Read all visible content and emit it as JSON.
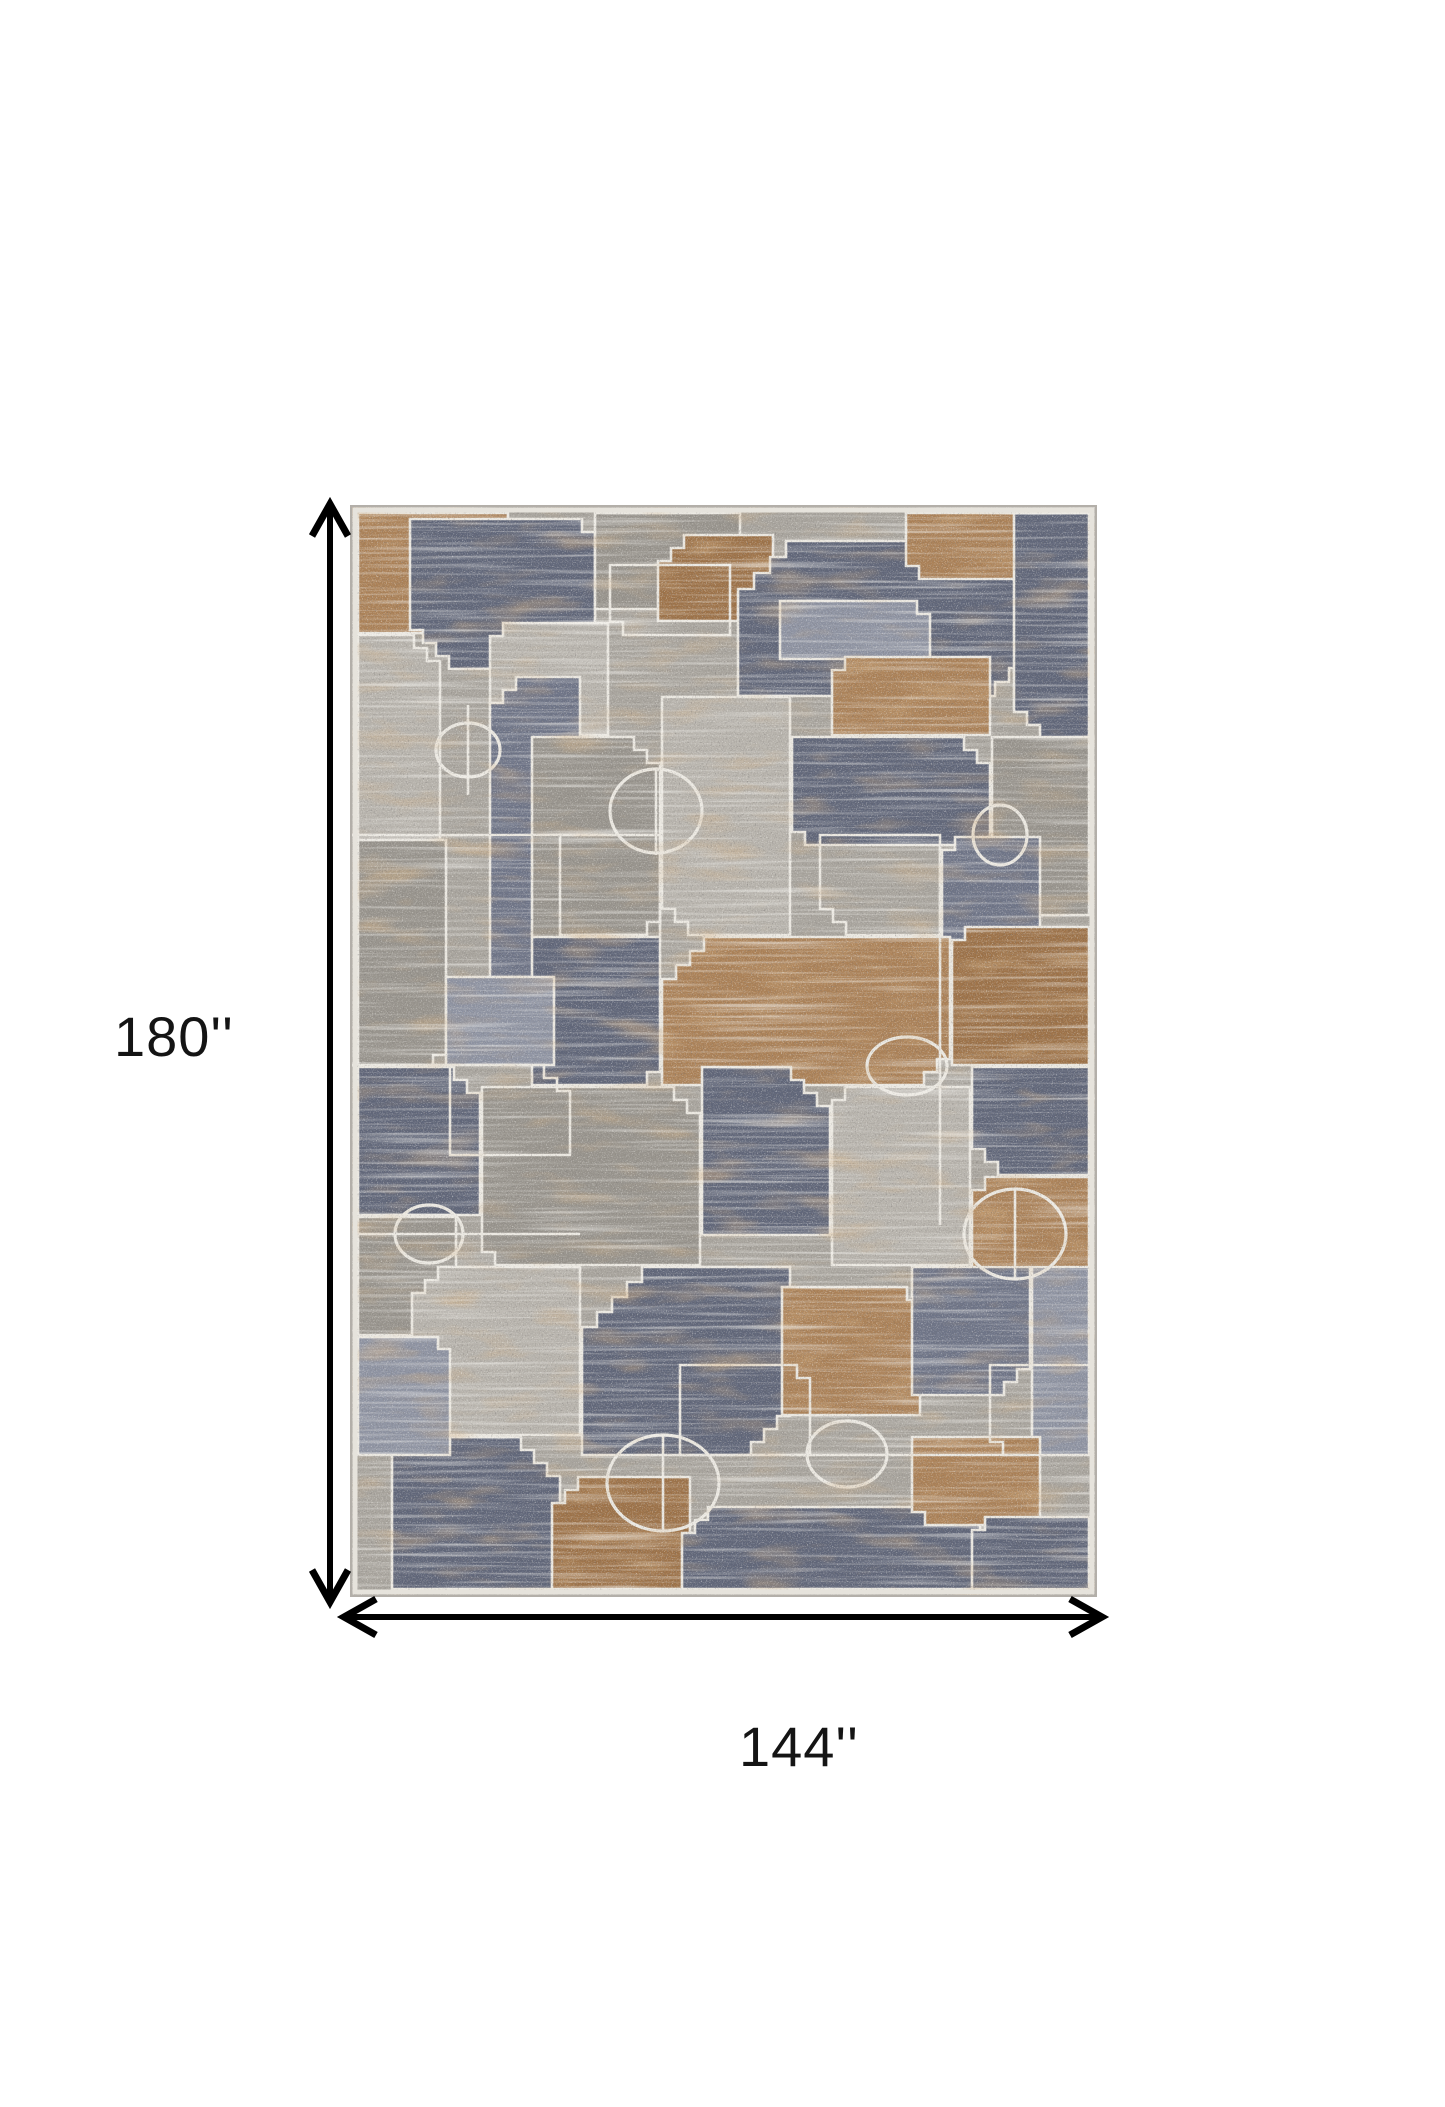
{
  "figure": {
    "type": "product-dimension-diagram",
    "subject": "geometric patchwork area rug"
  },
  "labels": {
    "height": {
      "text": "180''"
    },
    "width": {
      "text": "144''"
    }
  },
  "arrows": {
    "color": "#000000",
    "shaft_width": 6,
    "head_stroke_width": 7,
    "head_length": 32,
    "head_half_width": 18,
    "vertical": {
      "x": 330,
      "y_tip_top": 504,
      "y_tip_bottom": 1602
    },
    "horizontal": {
      "y": 1617,
      "x_tip_left": 344,
      "x_tip_right": 1102
    }
  },
  "rug": {
    "width": 747,
    "height": 1092,
    "palette": {
      "base": "#a8a49d",
      "slate": "#606679",
      "slate2": "#6e7487",
      "bgray": "#8e93a2",
      "gray": "#98948d",
      "lgray": "#b7b3ac",
      "tan": "#ab8157",
      "tan2": "#9d7248",
      "outline": "#ebe8e1",
      "edge_outer": "#b3afa9",
      "edge_inner": "#e6e3dc"
    },
    "patches": [
      {
        "x": 8,
        "y": 8,
        "w": 150,
        "h": 120,
        "f": "tan",
        "st": {
          "br": [
            3,
            13
          ]
        }
      },
      {
        "x": 60,
        "y": 14,
        "w": 185,
        "h": 150,
        "f": "slate",
        "st": {
          "bl": [
            4,
            13
          ],
          "tr": [
            2,
            13
          ]
        }
      },
      {
        "x": 245,
        "y": 8,
        "w": 145,
        "h": 96,
        "f": "gray",
        "st": {
          "br": [
            2,
            13
          ]
        }
      },
      {
        "x": 308,
        "y": 30,
        "w": 115,
        "h": 86,
        "f": "tan2",
        "st": {
          "tl": [
            3,
            13
          ]
        }
      },
      {
        "x": 388,
        "y": 36,
        "w": 285,
        "h": 155,
        "f": "slate",
        "st": {
          "tl": [
            4,
            16
          ],
          "br": [
            3,
            14
          ]
        }
      },
      {
        "x": 556,
        "y": 8,
        "w": 112,
        "h": 66,
        "f": "tan",
        "st": {
          "bl": [
            2,
            13
          ]
        }
      },
      {
        "x": 664,
        "y": 8,
        "w": 75,
        "h": 225,
        "f": "slate",
        "st": {
          "bl": [
            3,
            13
          ]
        }
      },
      {
        "x": 430,
        "y": 96,
        "w": 150,
        "h": 58,
        "f": "bgray",
        "st": {
          "tr": [
            2,
            13
          ]
        }
      },
      {
        "x": 140,
        "y": 118,
        "w": 118,
        "h": 112,
        "f": "lgray",
        "st": {
          "tl": [
            2,
            13
          ]
        }
      },
      {
        "x": 8,
        "y": 130,
        "w": 82,
        "h": 205,
        "f": "lgray",
        "st": {
          "tr": [
            3,
            13
          ]
        }
      },
      {
        "x": 140,
        "y": 172,
        "w": 90,
        "h": 300,
        "f": "slate2",
        "st": {
          "tl": [
            3,
            13
          ],
          "br": [
            3,
            13
          ]
        }
      },
      {
        "x": 8,
        "y": 335,
        "w": 88,
        "h": 228,
        "f": "gray",
        "st": {
          "br": [
            2,
            13
          ]
        }
      },
      {
        "x": 182,
        "y": 232,
        "w": 128,
        "h": 200,
        "f": "gray",
        "st": {
          "tr": [
            3,
            13
          ]
        }
      },
      {
        "x": 312,
        "y": 192,
        "w": 128,
        "h": 238,
        "f": "lgray",
        "st": {
          "bl": [
            3,
            13
          ]
        }
      },
      {
        "x": 442,
        "y": 232,
        "w": 198,
        "h": 108,
        "f": "slate",
        "st": {
          "tr": [
            3,
            13
          ],
          "bl": [
            2,
            13
          ]
        }
      },
      {
        "x": 482,
        "y": 152,
        "w": 158,
        "h": 78,
        "f": "tan",
        "st": {
          "tl": [
            2,
            13
          ]
        }
      },
      {
        "x": 642,
        "y": 232,
        "w": 97,
        "h": 178,
        "f": "gray",
        "st": {
          "bl": [
            3,
            13
          ]
        }
      },
      {
        "x": 592,
        "y": 332,
        "w": 98,
        "h": 108,
        "f": "slate2",
        "st": {
          "tl": [
            2,
            13
          ]
        }
      },
      {
        "x": 312,
        "y": 432,
        "w": 288,
        "h": 148,
        "f": "tan",
        "st": {
          "tl": [
            4,
            14
          ],
          "br": [
            3,
            13
          ]
        }
      },
      {
        "x": 602,
        "y": 422,
        "w": 137,
        "h": 138,
        "f": "tan2",
        "st": {
          "tl": [
            2,
            13
          ]
        }
      },
      {
        "x": 182,
        "y": 432,
        "w": 128,
        "h": 148,
        "f": "slate",
        "st": {
          "br": [
            2,
            13
          ]
        }
      },
      {
        "x": 8,
        "y": 562,
        "w": 122,
        "h": 148,
        "f": "slate",
        "st": {
          "tr": [
            3,
            13
          ]
        }
      },
      {
        "x": 96,
        "y": 472,
        "w": 108,
        "h": 88,
        "f": "bgray",
        "st": {}
      },
      {
        "x": 132,
        "y": 582,
        "w": 218,
        "h": 178,
        "f": "gray",
        "st": {
          "tr": [
            3,
            13
          ],
          "bl": [
            2,
            13
          ]
        }
      },
      {
        "x": 352,
        "y": 562,
        "w": 128,
        "h": 168,
        "f": "slate",
        "st": {
          "tr": [
            4,
            13
          ]
        }
      },
      {
        "x": 482,
        "y": 582,
        "w": 138,
        "h": 178,
        "f": "lgray",
        "st": {
          "tl": [
            2,
            13
          ]
        }
      },
      {
        "x": 622,
        "y": 562,
        "w": 117,
        "h": 108,
        "f": "slate",
        "st": {
          "bl": [
            3,
            13
          ]
        }
      },
      {
        "x": 622,
        "y": 672,
        "w": 117,
        "h": 98,
        "f": "tan",
        "st": {
          "tl": [
            2,
            13
          ]
        }
      },
      {
        "x": 8,
        "y": 712,
        "w": 98,
        "h": 118,
        "f": "gray",
        "st": {
          "br": [
            2,
            13
          ]
        }
      },
      {
        "x": 232,
        "y": 762,
        "w": 208,
        "h": 188,
        "f": "slate",
        "st": {
          "tl": [
            5,
            15
          ],
          "br": [
            4,
            13
          ]
        }
      },
      {
        "x": 432,
        "y": 782,
        "w": 138,
        "h": 128,
        "f": "tan",
        "st": {
          "tr": [
            2,
            13
          ]
        }
      },
      {
        "x": 62,
        "y": 762,
        "w": 168,
        "h": 168,
        "f": "lgray",
        "st": {
          "tl": [
            3,
            13
          ]
        }
      },
      {
        "x": 562,
        "y": 762,
        "w": 118,
        "h": 128,
        "f": "slate2",
        "st": {
          "br": [
            3,
            13
          ]
        }
      },
      {
        "x": 682,
        "y": 762,
        "w": 57,
        "h": 188,
        "f": "bgray",
        "st": {}
      },
      {
        "x": 42,
        "y": 932,
        "w": 168,
        "h": 152,
        "f": "slate",
        "st": {
          "tr": [
            4,
            13
          ]
        }
      },
      {
        "x": 202,
        "y": 972,
        "w": 138,
        "h": 112,
        "f": "tan2",
        "st": {
          "tl": [
            3,
            13
          ]
        }
      },
      {
        "x": 332,
        "y": 1002,
        "w": 298,
        "h": 82,
        "f": "slate",
        "st": {
          "tl": [
            3,
            13
          ],
          "tr": [
            2,
            13
          ]
        }
      },
      {
        "x": 562,
        "y": 932,
        "w": 128,
        "h": 88,
        "f": "tan",
        "st": {
          "bl": [
            2,
            13
          ]
        }
      },
      {
        "x": 622,
        "y": 1012,
        "w": 117,
        "h": 72,
        "f": "slate",
        "st": {
          "tl": [
            2,
            13
          ]
        }
      },
      {
        "x": 8,
        "y": 832,
        "w": 92,
        "h": 118,
        "f": "bgray",
        "st": {
          "tr": [
            2,
            12
          ]
        }
      },
      {
        "x": 260,
        "y": 60,
        "w": 120,
        "h": 70,
        "f": "none",
        "st": {
          "bl": [
            2,
            13
          ]
        }
      },
      {
        "x": 100,
        "y": 560,
        "w": 120,
        "h": 90,
        "f": "none",
        "st": {
          "tr": [
            3,
            13
          ]
        }
      },
      {
        "x": 470,
        "y": 330,
        "w": 120,
        "h": 100,
        "f": "none",
        "st": {
          "bl": [
            3,
            13
          ]
        }
      },
      {
        "x": 330,
        "y": 860,
        "w": 130,
        "h": 90,
        "f": "none",
        "st": {
          "tr": [
            2,
            13
          ]
        }
      },
      {
        "x": 640,
        "y": 860,
        "w": 100,
        "h": 90,
        "f": "none",
        "st": {
          "bl": [
            2,
            13
          ]
        }
      },
      {
        "x": 210,
        "y": 330,
        "w": 100,
        "h": 100,
        "f": "none",
        "st": {
          "br": [
            2,
            13
          ]
        }
      }
    ],
    "ellipses": [
      [
        118,
        245,
        32,
        27
      ],
      [
        306,
        306,
        46,
        42
      ],
      [
        557,
        561,
        40,
        29
      ],
      [
        650,
        330,
        27,
        30
      ],
      [
        79,
        729,
        34,
        29
      ],
      [
        313,
        978,
        56,
        48
      ],
      [
        497,
        949,
        40,
        33
      ],
      [
        665,
        729,
        51,
        45
      ]
    ],
    "lines": [
      [
        0,
        330,
        310,
        330
      ],
      [
        8,
        729,
        230,
        729
      ],
      [
        590,
        340,
        590,
        720
      ],
      [
        440,
        950,
        680,
        950
      ],
      [
        306,
        264,
        306,
        350
      ],
      [
        313,
        930,
        313,
        1026
      ],
      [
        665,
        684,
        665,
        774
      ],
      [
        0,
        560,
        180,
        560
      ],
      [
        118,
        200,
        118,
        290
      ]
    ]
  }
}
